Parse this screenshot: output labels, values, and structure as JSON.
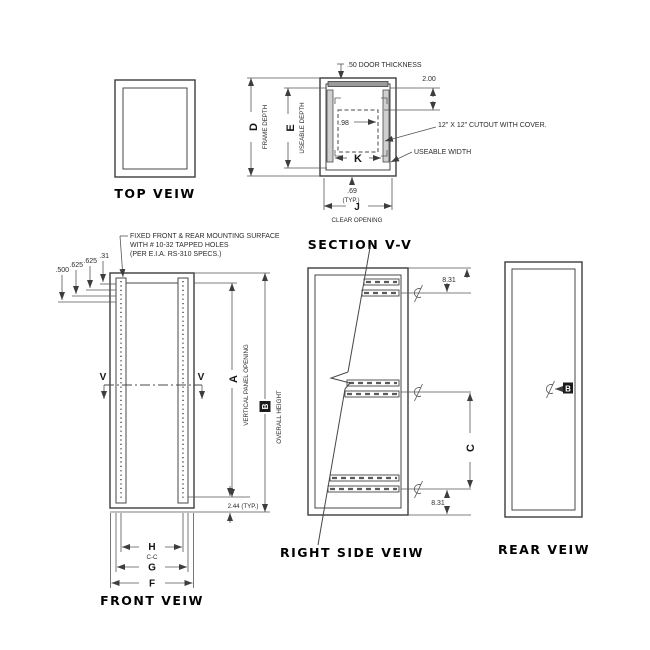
{
  "views": {
    "top": {
      "label": "TOP VEIW"
    },
    "section": {
      "label": "SECTION V-V",
      "door_thickness": ".50 DOOR THICKNESS",
      "dim_2_00": "2.00",
      "dim_0_98": ".98",
      "cutout_note": "12\" X 12\" CUTOUT WITH COVER.",
      "useable_width": "USEABLE WIDTH",
      "dim_0_69": ".69",
      "typ": "(TYP.)",
      "letter_j": "J",
      "clear_opening": "CLEAR OPENING",
      "letter_d": "D",
      "frame_depth": "FRAME DEPTH",
      "letter_e": "E",
      "useable_depth": "USEABLE DEPTH",
      "letter_k": "K"
    },
    "front": {
      "label": "FRONT VEIW",
      "note_line1": "FIXED FRONT & REAR MOUNTING SURFACE",
      "note_line2": "WITH # 10-32 TAPPED HOLES",
      "note_line3": "(PER E.I.A. RS-310 SPECS.)",
      "dim_500": ".500",
      "dim_625a": ".625",
      "dim_625b": ".625",
      "dim_31": ".31",
      "v_left": "V",
      "v_right": "V",
      "letter_a": "A",
      "vertical_panel_opening": "VERTICAL PANEL OPENING",
      "letter_b": "B",
      "overall_height": "OVERALL HEIGHT",
      "dim_244": "2.44 (TYP.)",
      "letter_h": "H",
      "h_sub": "C-C",
      "letter_g": "G",
      "letter_f": "F"
    },
    "right": {
      "label": "RIGHT SIDE VEIW",
      "dim_831_top": "8.31",
      "dim_831_bottom": "8.31",
      "letter_c": "C"
    },
    "rear": {
      "label": "REAR VEIW",
      "letter_b": "B"
    }
  },
  "colors": {
    "line": "#3d3d3d",
    "rail_fill": "#cfcfcf",
    "door_fill": "#9a9a9a",
    "label_box": "#1b1b1b"
  }
}
